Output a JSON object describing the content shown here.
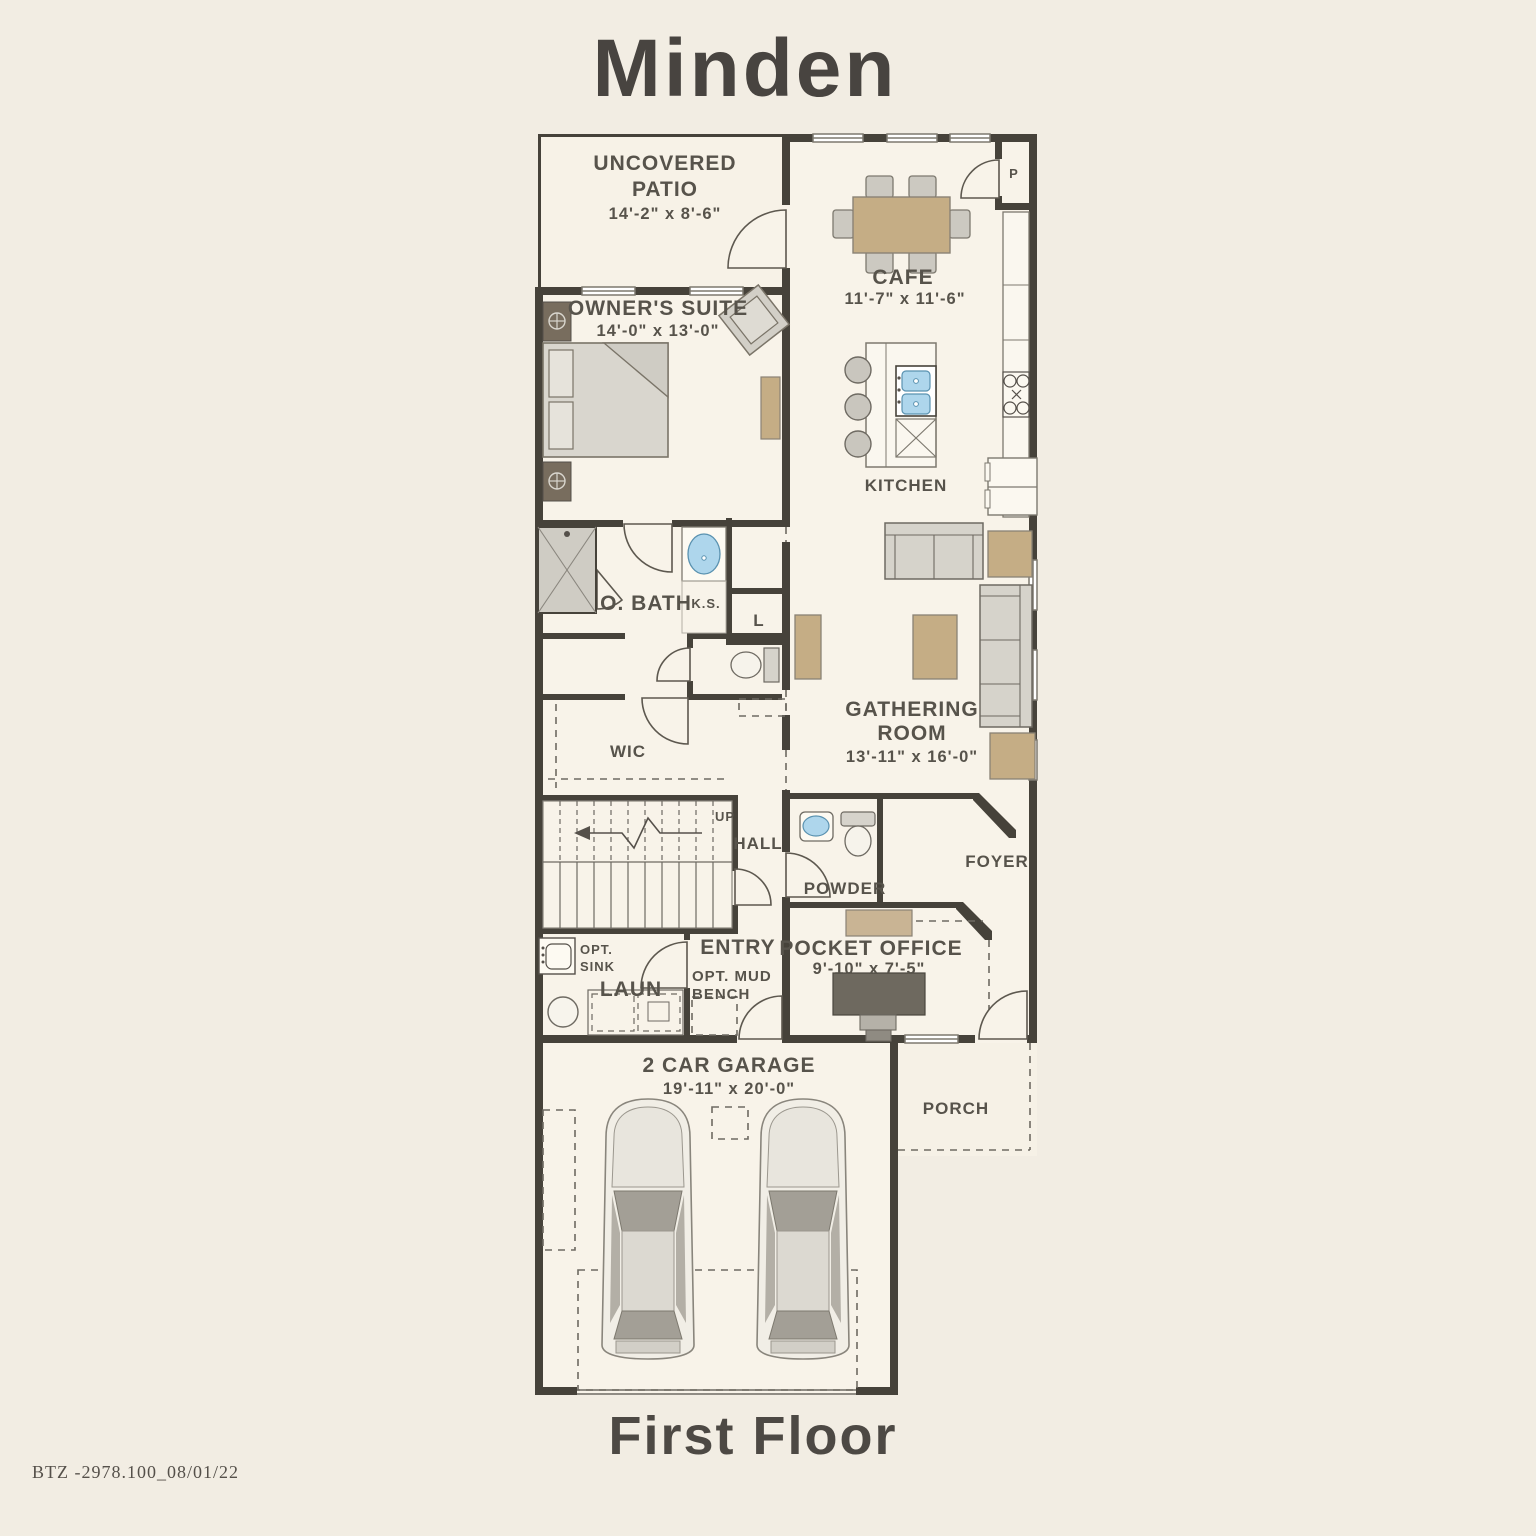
{
  "page": {
    "title": "Minden",
    "floor_label": "First Floor",
    "plan_code": "BTZ -2978.100_08/01/22"
  },
  "colors": {
    "background": "#f2ede3",
    "room_fill": "#f8f3e9",
    "wall": "#46423a",
    "furniture_tan": "#c5ad85",
    "furniture_gray": "#d6d3cb",
    "fixture_blue": "#aed6ec",
    "text": "#57534b"
  },
  "rooms": {
    "patio": {
      "line1": "UNCOVERED",
      "line2": "PATIO",
      "dims": "14'-2\" x 8'-6\""
    },
    "cafe": {
      "name": "CAFE",
      "dims": "11'-7\" x 11'-6\""
    },
    "owners_suite": {
      "name": "OWNER'S SUITE",
      "dims": "14'-0\" x 13'-0\""
    },
    "kitchen": {
      "name": "KITCHEN"
    },
    "pantry": {
      "name": "P"
    },
    "o_bath": {
      "name": "O. BATH"
    },
    "knee_space": {
      "name": "K.S."
    },
    "linen": {
      "name": "L"
    },
    "wic": {
      "name": "WIC"
    },
    "gathering": {
      "line1": "GATHERING",
      "line2": "ROOM",
      "dims": "13'-11\" x 16'-0\""
    },
    "hall": {
      "name": "HALL"
    },
    "stairs": {
      "direction": "UP"
    },
    "powder": {
      "name": "POWDER"
    },
    "foyer": {
      "name": "FOYER"
    },
    "entry": {
      "name": "ENTRY"
    },
    "mud_bench": {
      "line1": "OPT. MUD",
      "line2": "BENCH"
    },
    "opt_sink": {
      "line1": "OPT.",
      "line2": "SINK"
    },
    "laundry": {
      "name": "LAUN"
    },
    "pocket_office": {
      "name": "POCKET OFFICE",
      "dims": "9'-10\" x 7'-5\""
    },
    "garage": {
      "name": "2 CAR GARAGE",
      "dims": "19'-11\" x 20'-0\""
    },
    "porch": {
      "name": "PORCH"
    }
  }
}
